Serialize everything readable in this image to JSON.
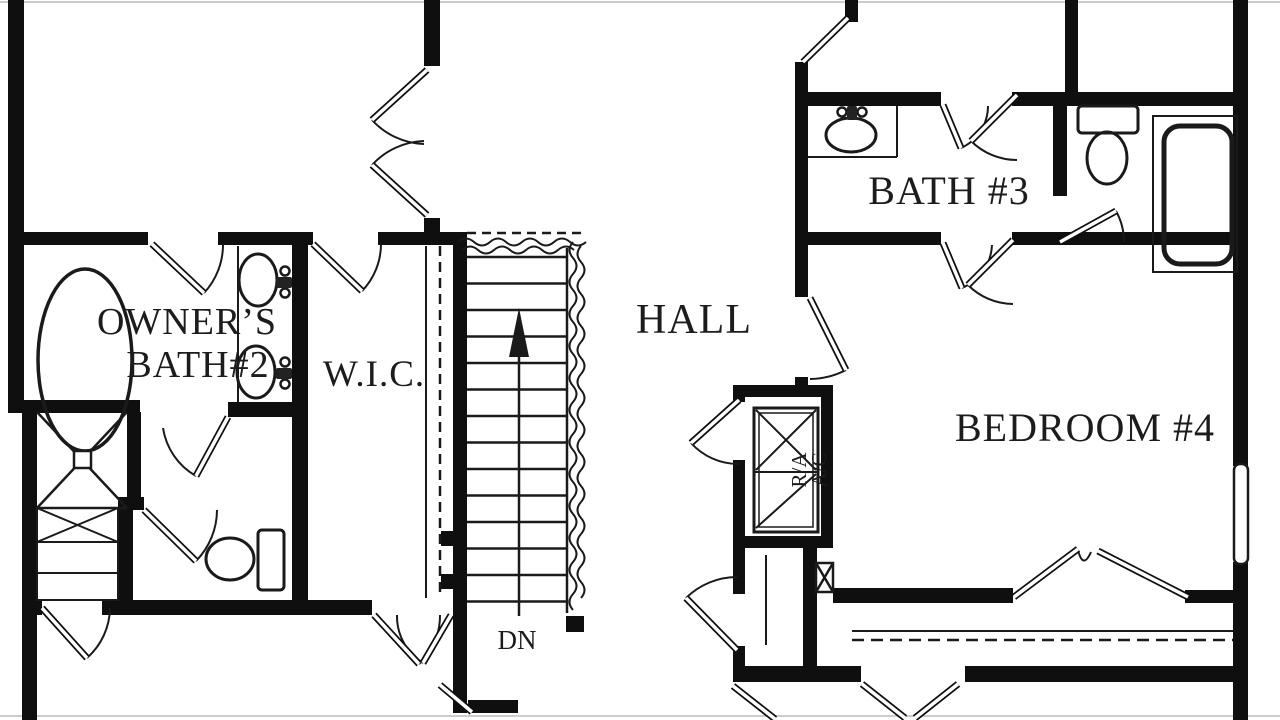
{
  "labels": {
    "owners_bath_line1": "OWNER’S",
    "owners_bath_line2": "BATH#2",
    "wic": "W.I.C.",
    "hall": "HALL",
    "bath3": "BATH #3",
    "bedroom4": "BEDROOM #4",
    "stairs_down": "DN",
    "hvac_line1": "R/A",
    "hvac_line2": "A/C"
  },
  "colors": {
    "wall": "#0f0f0f",
    "line": "#1a1a1a",
    "background": "#ffffff",
    "letterbox": "#cccccc"
  }
}
